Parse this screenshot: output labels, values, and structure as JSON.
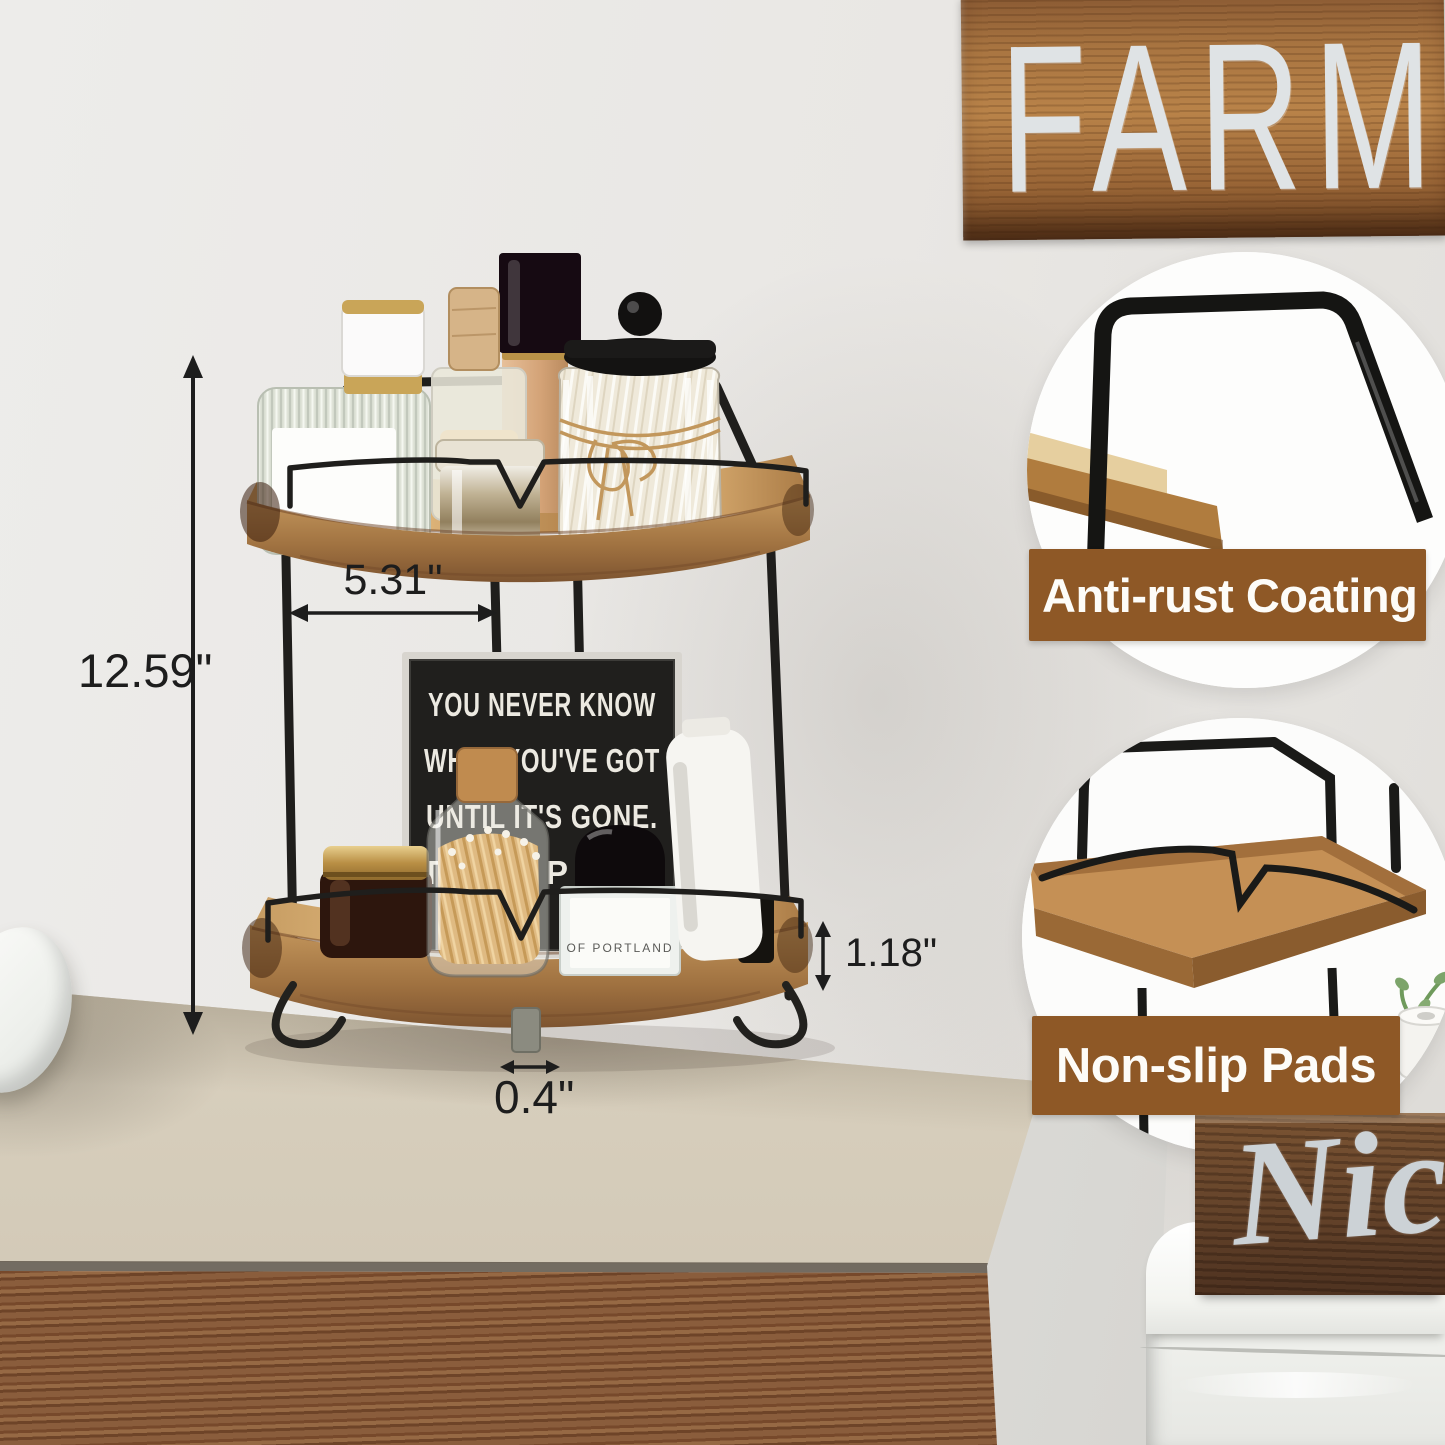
{
  "scene": {
    "wall_color": "#e9e7e4",
    "counter_color": "#cdc3b1",
    "cabinet_wood_color": "#7d5434",
    "metal_color": "#1f1e1c",
    "shelf_wood_light": "#d9ae72",
    "shelf_wood_dark": "#7d5430",
    "banner_color": "#8e5826"
  },
  "annotations": {
    "overall_height": "12.59\"",
    "tier_clearance": "5.31\"",
    "shelf_thickness": "1.18\"",
    "foot_height": "0.4\""
  },
  "callouts": [
    {
      "label": "Anti-rust Coating"
    },
    {
      "label": "Non-slip Pads"
    }
  ],
  "sign_board": {
    "line1": "YOU NEVER KNOW",
    "line2": "WHAT YOU'VE GOT",
    "line3": "UNTIL IT'S GONE.",
    "line4_fragment_left": "T",
    "line4_fragment_right": "P A"
  },
  "background_text": {
    "wall_sign": "FARMHO",
    "toilet_box": "Nice"
  },
  "product_labels": {
    "perfume_front": "OF PORTLAND"
  }
}
